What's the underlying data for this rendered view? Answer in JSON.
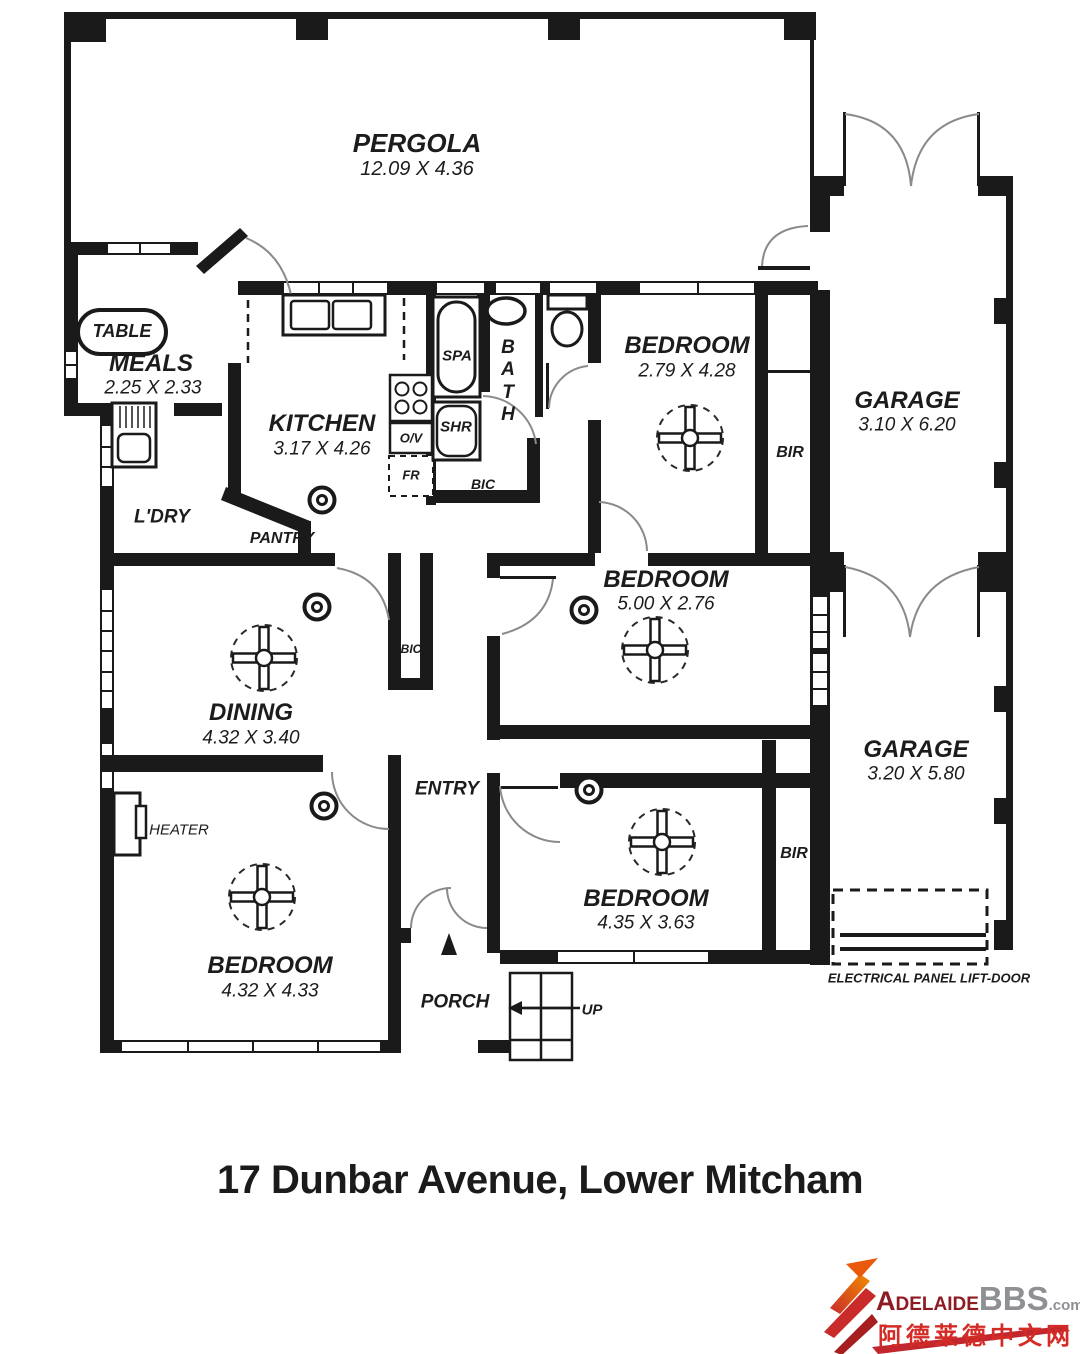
{
  "rooms": {
    "pergola": {
      "name": "PERGOLA",
      "dims": "12.09 X 4.36"
    },
    "meals": {
      "name": "MEALS",
      "dims": "2.25 X 2.33"
    },
    "kitchen": {
      "name": "KITCHEN",
      "dims": "3.17 X 4.26"
    },
    "bedroom1": {
      "name": "BEDROOM",
      "dims": "2.79 X 4.28"
    },
    "garage1": {
      "name": "GARAGE",
      "dims": "3.10 X 6.20"
    },
    "bedroom2": {
      "name": "BEDROOM",
      "dims": "5.00 X 2.76"
    },
    "dining": {
      "name": "DINING",
      "dims": "4.32 X 3.40"
    },
    "garage2": {
      "name": "GARAGE",
      "dims": "3.20 X 5.80"
    },
    "bedroom4": {
      "name": "BEDROOM",
      "dims": "4.35 X 3.63"
    },
    "bedroom3": {
      "name": "BEDROOM",
      "dims": "4.32 X 4.33"
    }
  },
  "labels": {
    "table": "TABLE",
    "laundry": "L'DRY",
    "pantry": "PANTRY",
    "spa": "SPA",
    "shower": "SHR",
    "bath": "BATH",
    "bic_bath": "BIC",
    "bic_hall": "BIC",
    "oven": "O/V",
    "fridge": "FR",
    "bir1": "BIR",
    "bir2": "BIR",
    "heater": "HEATER",
    "entry": "ENTRY",
    "porch": "PORCH",
    "up": "UP",
    "electrical": "ELECTRICAL PANEL LIFT-DOOR"
  },
  "footer": {
    "address": "17 Dunbar Avenue, Lower Mitcham"
  },
  "logo": {
    "brand_primary": "Adelaide",
    "brand_secondary": "BBS",
    "brand_tld": ".com",
    "tagline_cn": "阿德莱德中文网"
  },
  "colors": {
    "wall": "#1a1a1a",
    "door_arc": "#8a8a8a",
    "logo_red": "#8d1b21",
    "logo_gray": "#8e9094",
    "logo_cn_red": "#d42b26"
  }
}
